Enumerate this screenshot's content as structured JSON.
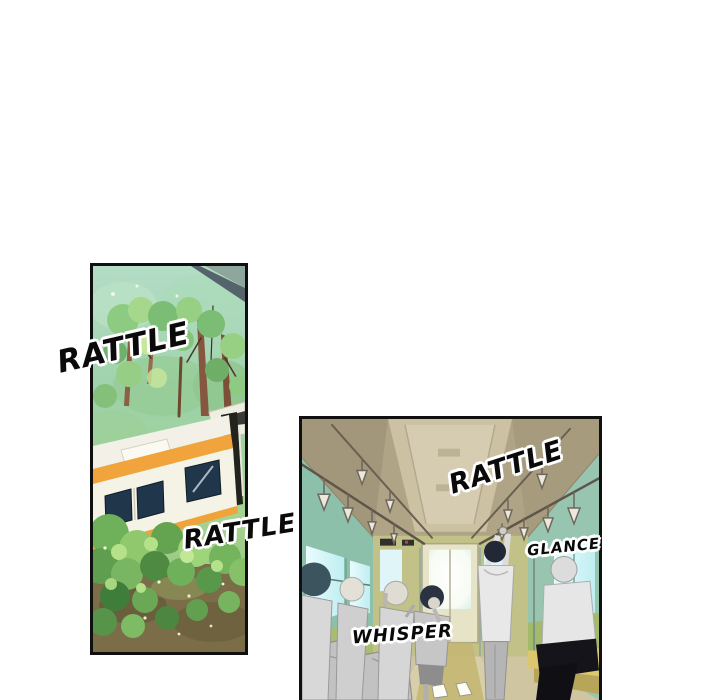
{
  "page": {
    "kind": "comic-page",
    "background_color": "#ffffff",
    "panel_border_color": "#101010"
  },
  "panels": [
    {
      "id": "forest-train",
      "description": "Aerial view of a white train with an orange stripe passing through green forest and bushes"
    },
    {
      "id": "train-interior",
      "description": "Inside a train car: hanging straps, glowing windows and door, standing and seated passengers"
    }
  ],
  "sound_effects": [
    {
      "text": "RATTLE",
      "panel": "forest-train",
      "position": "left-edge"
    },
    {
      "text": "RATTLE",
      "panel": "forest-train",
      "position": "bottom-right"
    },
    {
      "text": "RATTLE",
      "panel": "train-interior",
      "position": "top-center"
    },
    {
      "text": "GLANCE",
      "panel": "train-interior",
      "position": "right-of-standing-man"
    },
    {
      "text": "WHISPER",
      "panel": "train-interior",
      "position": "bottom-left"
    }
  ],
  "palette": {
    "forest_top": "#a9d6b0",
    "forest_green": "#84c178",
    "tree_trunk": "#8f5f45",
    "train_body": "#f5f2e7",
    "train_stripe": "#f0a43b",
    "train_window": "#20364a",
    "bush_green": "#74b45c",
    "ground_olive": "#7b6d48",
    "ceiling_tan": "#b0a486",
    "wall_teal": "#8cc0ab",
    "backwall_yellow_green": "#c2c187",
    "window_glow": "#eafcfd",
    "seat_yellow": "#dcc76e",
    "seat_green": "#a3bb68",
    "figure_gray": "#d2d2d2",
    "black_pants": "#14141a"
  }
}
